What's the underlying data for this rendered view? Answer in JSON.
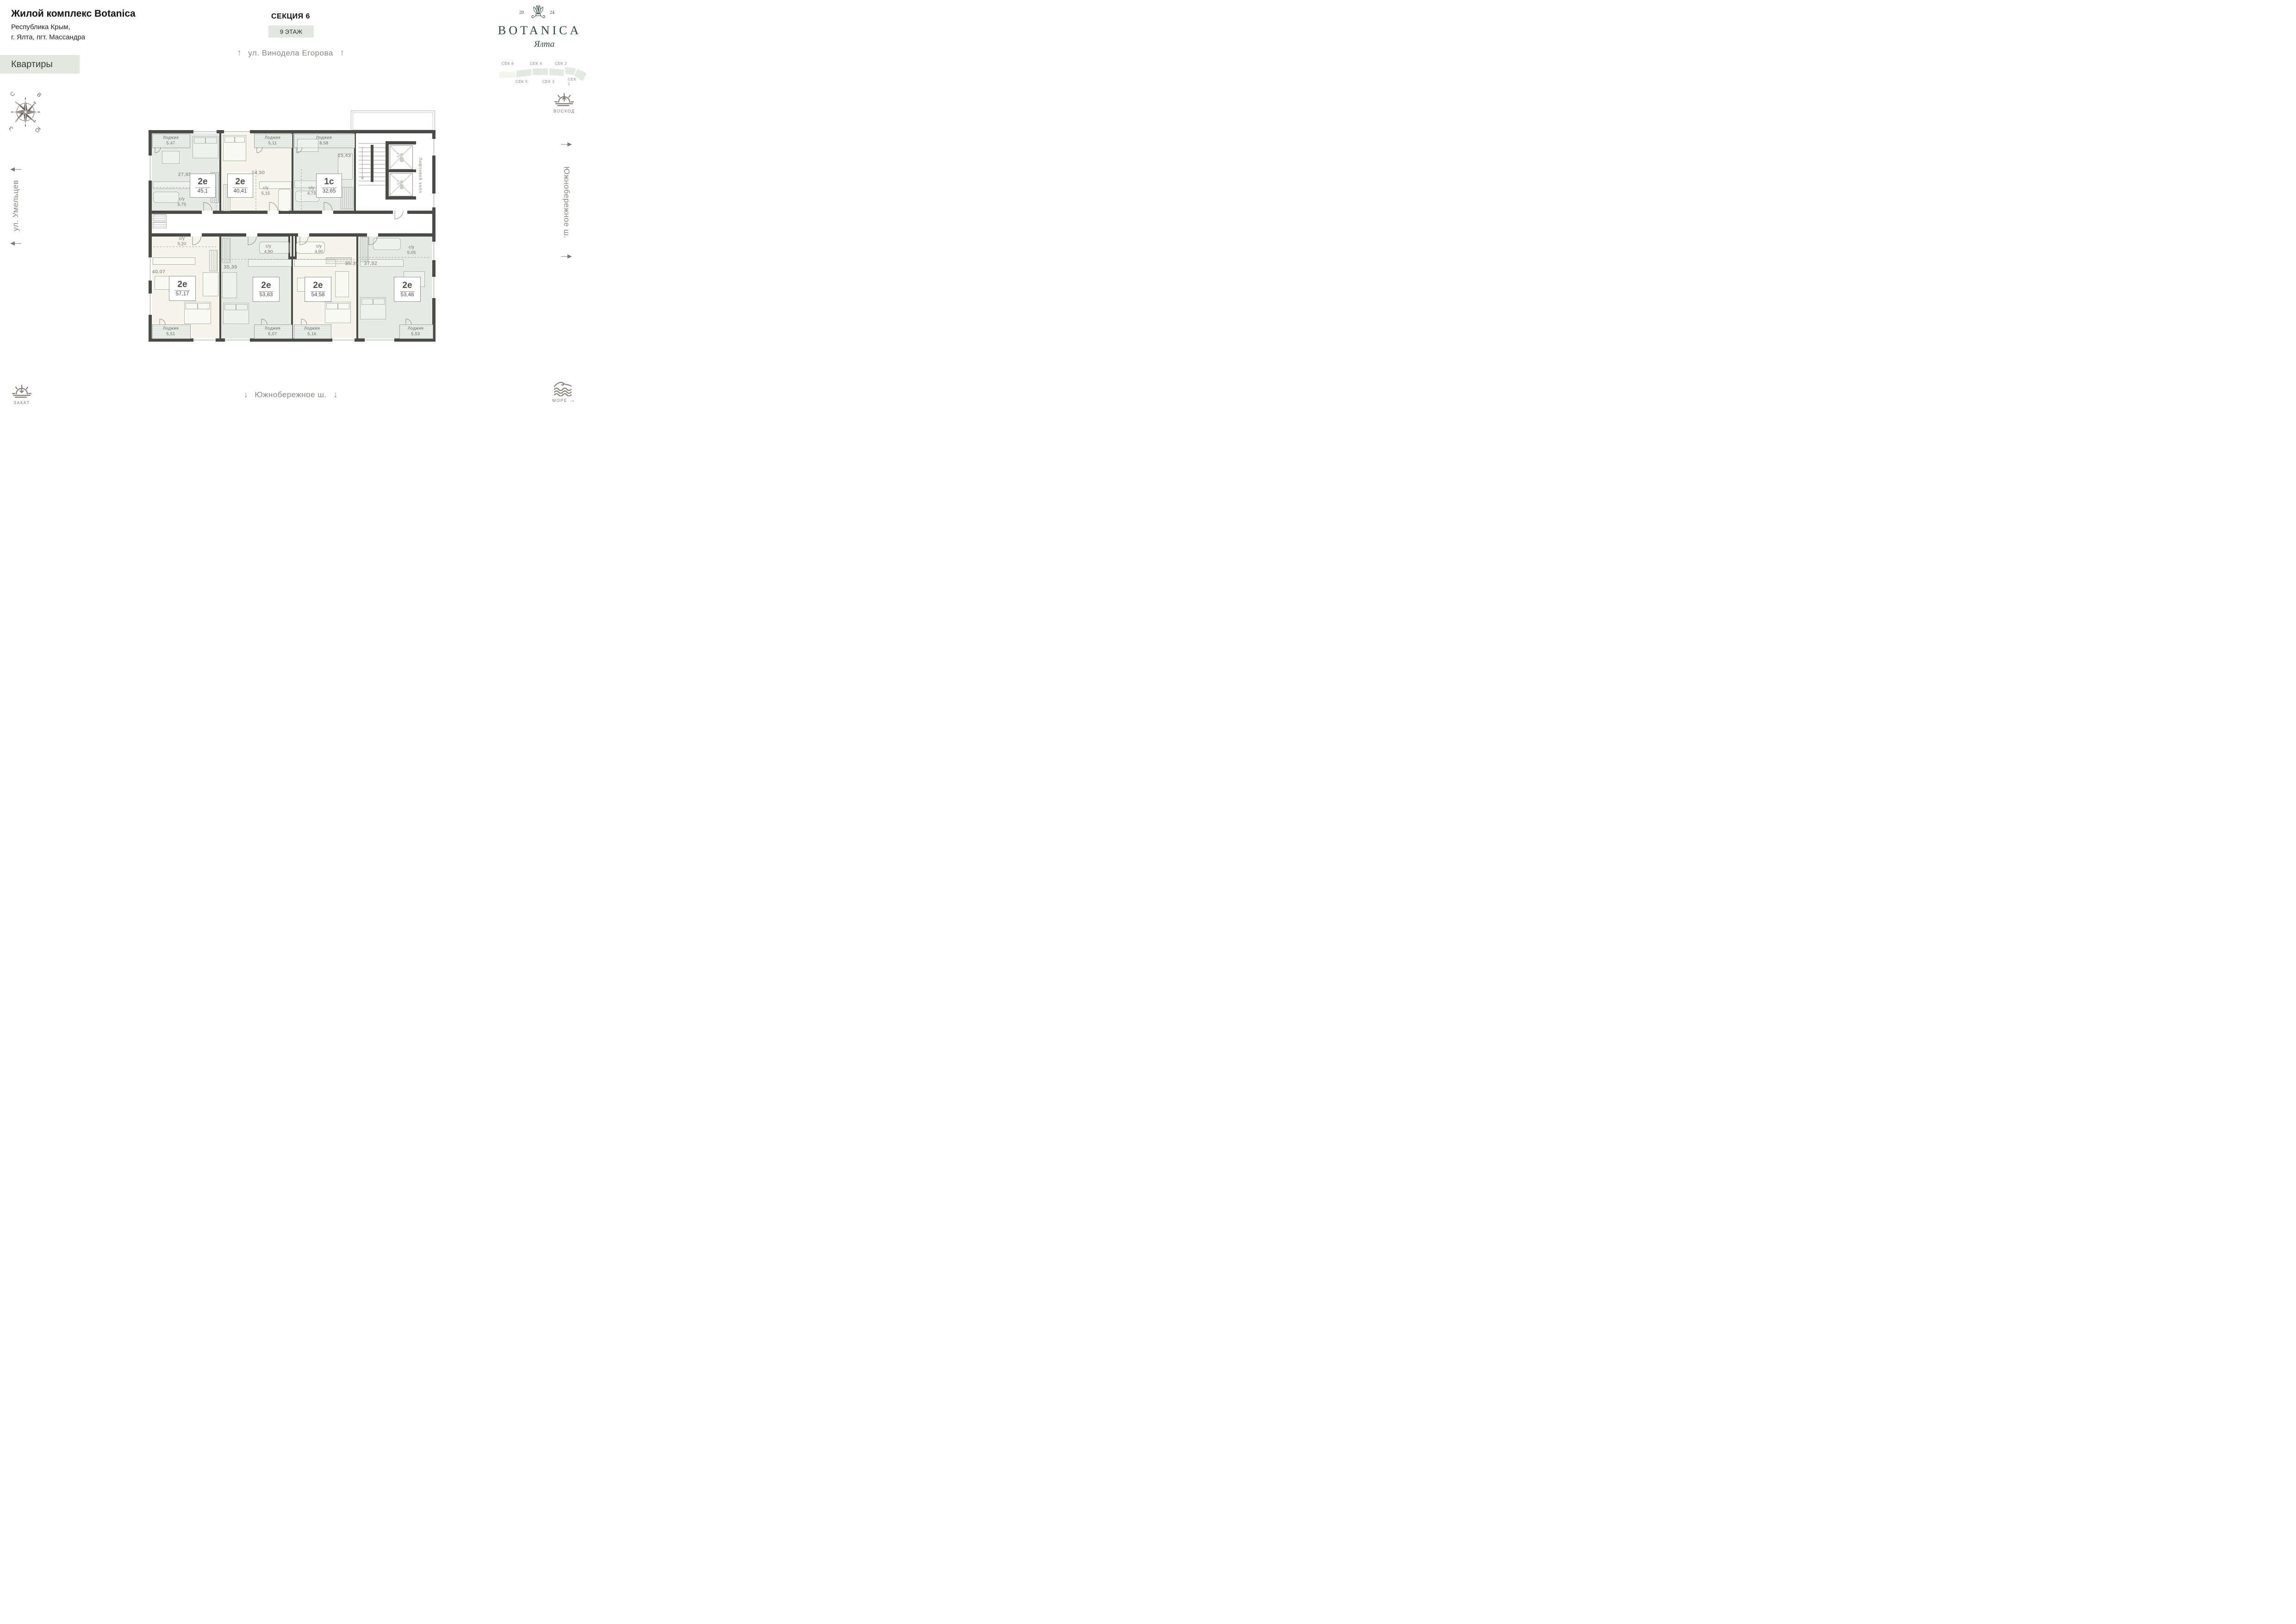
{
  "header": {
    "title": "Жилой комплекс Botanica",
    "address1": "Республика Крым,",
    "address2": "г. Ялта, пгт. Массандра",
    "apartments_tab": "Квартиры",
    "section": "СЕКЦИЯ 6",
    "floor": "9 ЭТАЖ"
  },
  "logo": {
    "year_left": "20",
    "year_right": "24",
    "name": "BOTANICA",
    "city": "Ялта"
  },
  "section_map": {
    "s6": "СЕК 6",
    "s5": "СЕК 5",
    "s4": "СЕК 4",
    "s3": "СЕК 3",
    "s2": "СЕК 2",
    "s1": "СЕК 1"
  },
  "compass": {
    "n": "С",
    "e": "В",
    "w": "З",
    "s": "Ю"
  },
  "streets": {
    "top": "ул. Винодела Егорова",
    "left": "ул. Умельцев",
    "right": "Южнобережное ш.",
    "bottom": "Южнобережное ш.",
    "arrow_up": "↑",
    "arrow_down": "↓"
  },
  "markers": {
    "sunrise": "ВОСХОД",
    "sunset": "ЗАКАТ",
    "sea": "МОРЕ",
    "sea_arrow": "→"
  },
  "plan": {
    "lift_hall_line1": "Лифтовой",
    "lift_hall_line2": "холл",
    "wc_label": "с/у",
    "loggia_label": "Лоджия",
    "apartments": [
      {
        "type": "2е",
        "area": "45,1",
        "living": "27,65",
        "wc": "5,75",
        "loggia": "5,47"
      },
      {
        "type": "2е",
        "area": "40,41",
        "living": "24,50",
        "wc": "5,15",
        "loggia": "5,11"
      },
      {
        "type": "1с",
        "area": "32,65",
        "living": "15,43",
        "wc": "4,73",
        "loggia": "8,58"
      },
      {
        "type": "2е",
        "area": "57,17",
        "living": "40,07",
        "wc": "5,20",
        "loggia": "5,51"
      },
      {
        "type": "2е",
        "area": "53,83",
        "living": "35,39",
        "wc": "4,90",
        "loggia": "5,07"
      },
      {
        "type": "2е",
        "area": "54,58",
        "living": "35,39",
        "wc": "4,90",
        "loggia": "5,16"
      },
      {
        "type": "2е",
        "area": "53,48",
        "living": "37,52",
        "wc": "5,05",
        "loggia": "5,53"
      }
    ]
  },
  "colors": {
    "wall": "#4a4a47",
    "sage": "#e5eae4",
    "cream": "#f5f6e9",
    "accent_green": "#2b4a3b",
    "label_gray": "#8b8680"
  }
}
